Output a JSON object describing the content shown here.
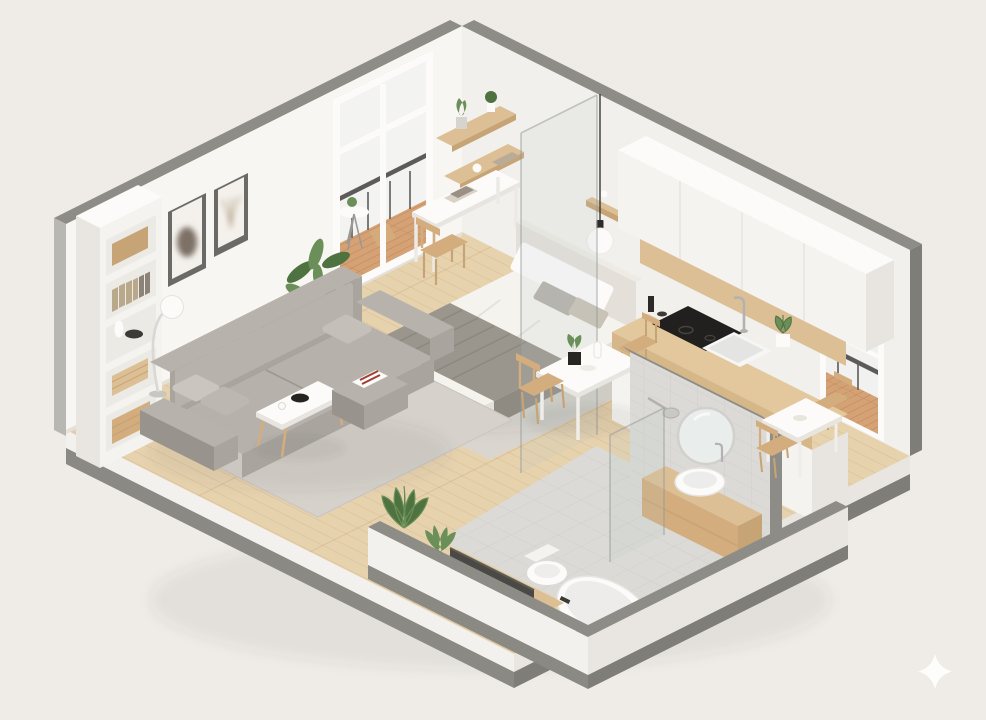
{
  "scene": {
    "type": "3d-isometric-cutaway-floor-plan",
    "subject": "studio-apartment",
    "areas": [
      "living-area",
      "sleeping-area",
      "kitchen",
      "dining-nook",
      "bathroom",
      "balcony"
    ],
    "watermark_icon": "sparkle-icon"
  },
  "palette": {
    "bg": "#efece7",
    "cut": "#8e8c86",
    "cutD": "#7f7d78",
    "wallL": "#f8f6f2",
    "wallR": "#f2f0ec",
    "wallS": "#b9b7b2",
    "slab": "#f3f1ed",
    "slabD": "#e9e6e1",
    "base": "#8b8983",
    "wood": "#e7d2ae",
    "woodLine": "#d5bc93",
    "deck": "#d5a276",
    "deckLine": "#c28a5e",
    "woodS": "#dcbf94",
    "woodD": "#c6a476",
    "woodLeg": "#d3ad7e",
    "cab": "#f5f3ef",
    "cabD": "#e8e5e0",
    "ctrTop": "#e3c89d",
    "ctrFace": "#d5b78a",
    "cook": "#21201e",
    "sofa": "#a9a59e",
    "sofaL": "#b7b3ac",
    "sofaD": "#98948d",
    "pil": "#cac6bf",
    "rug": "#d6d2cb",
    "rugB": "#dad6cf",
    "bedW": "#f5f3ee",
    "bedS": "#e4e0d9",
    "bedF": "#ddd8d0",
    "throw": "#9a968d",
    "throwD": "#85817a",
    "tile": "#dbdad6",
    "tileL": "#cac9c5",
    "mir": "#e9edec",
    "metal": "#b3b2b0",
    "dark": "#3c3a37",
    "tv": "#4b4946",
    "plant": "#6b8f58",
    "plantD": "#4f7340",
    "pot": "#d7d4cf",
    "white": "#fcfbf9",
    "frameD": "#6c6a66",
    "mat": "#f4f1ec",
    "rail": "#5c5b58",
    "spark": "#fdfdfb",
    "glassT": "rgba(188,196,196,0.16)",
    "glassE": "rgba(145,152,152,0.5)",
    "shadow": "rgba(70,66,60,0.07)",
    "bottle": "#2b2a27"
  }
}
